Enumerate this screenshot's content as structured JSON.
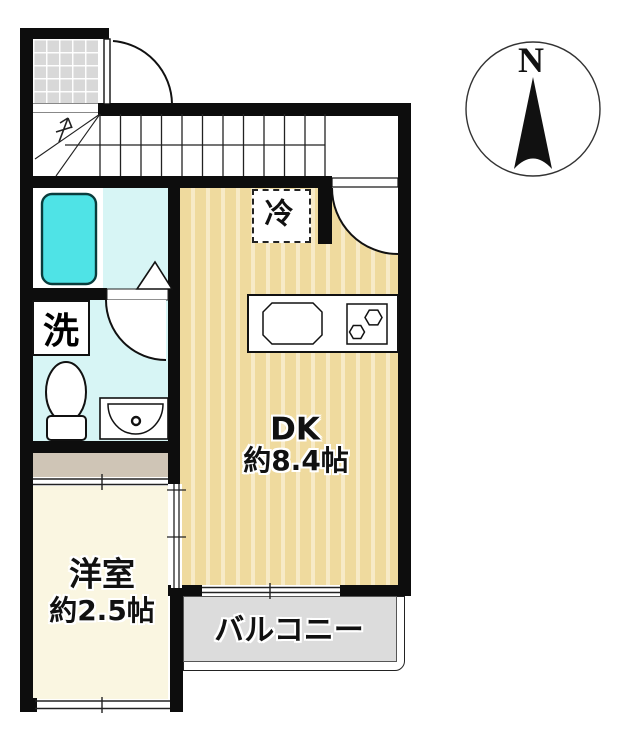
{
  "compass": {
    "north": "N"
  },
  "labels": {
    "dk": "DK",
    "dk_size": "約8.4帖",
    "western_room": "洋室",
    "western_room_size": "約2.5帖",
    "balcony": "バルコニー",
    "refrigerator": "冷",
    "washer": "洗"
  },
  "colors": {
    "wall": "#0d0d0d",
    "dk_floor": "#efda9e",
    "dk_floor_stripe": "#f7eac7",
    "western_room_floor": "#faf6e1",
    "wet_area_floor": "#d7f5f5",
    "bathtub_fill": "#4fe3e6",
    "closet_floor": "#cfc5b6",
    "balcony_floor": "#dcdcdc",
    "entrance_tile": "#d8d8d8"
  }
}
